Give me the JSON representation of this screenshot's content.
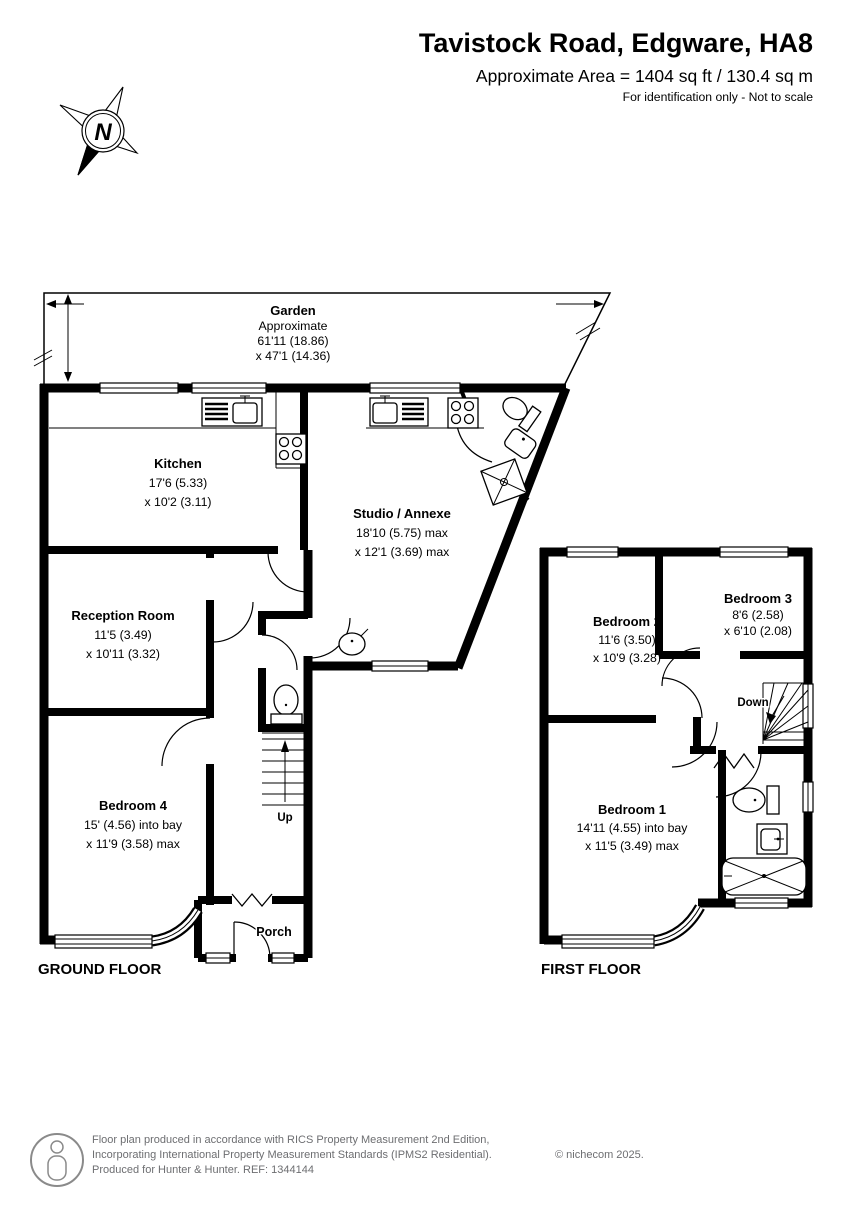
{
  "header": {
    "title": "Tavistock Road, Edgware, HA8",
    "area_line": "Approximate Area = 1404 sq ft / 130.4 sq m",
    "disclaimer": "For identification only - Not to scale"
  },
  "compass": {
    "north_label": "N"
  },
  "ground_floor": {
    "floor_label": "GROUND FLOOR",
    "garden": {
      "name": "Garden",
      "approx": "Approximate",
      "dim1": "61'11 (18.86)",
      "dim2": "x 47'1 (14.36)"
    },
    "kitchen": {
      "name": "Kitchen",
      "dim1": "17'6 (5.33)",
      "dim2": "x 10'2 (3.11)"
    },
    "studio": {
      "name": "Studio / Annexe",
      "dim1": "18'10 (5.75) max",
      "dim2": "x 12'1 (3.69) max"
    },
    "reception": {
      "name": "Reception Room",
      "dim1": "11'5 (3.49)",
      "dim2": "x 10'11 (3.32)"
    },
    "bedroom4": {
      "name": "Bedroom 4",
      "dim1": "15' (4.56) into bay",
      "dim2": "x 11'9 (3.58) max"
    },
    "porch": {
      "name": "Porch"
    },
    "stairs_label": "Up"
  },
  "first_floor": {
    "floor_label": "FIRST FLOOR",
    "bedroom1": {
      "name": "Bedroom 1",
      "dim1": "14'11 (4.55) into bay",
      "dim2": "x 11'5 (3.49) max"
    },
    "bedroom2": {
      "name": "Bedroom 2",
      "dim1": "11'6 (3.50)",
      "dim2": "x 10'9 (3.28)"
    },
    "bedroom3": {
      "name": "Bedroom 3",
      "dim1": "8'6 (2.58)",
      "dim2": "x 6'10 (2.08)"
    },
    "stairs_label": "Down"
  },
  "footer": {
    "line1": "Floor plan produced in accordance with RICS Property Measurement 2nd Edition,",
    "line2": "Incorporating International Property Measurement Standards (IPMS2 Residential).",
    "copyright": "© nichecom 2025.",
    "line3": "Produced for Hunter & Hunter.   REF: 1344144"
  },
  "colors": {
    "wall": "#000000",
    "background": "#ffffff",
    "footer_text": "#6d6e71"
  }
}
